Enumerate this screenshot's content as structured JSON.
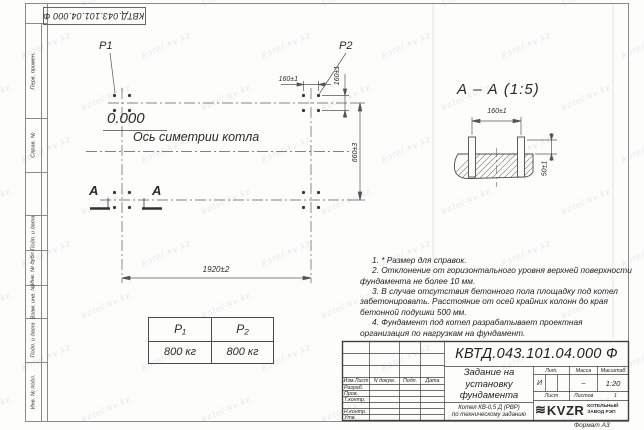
{
  "page": {
    "stamp_top": "КВТД.043.101.04.000 Ф",
    "format_label": "Формат А3",
    "watermark": "kotel-kv.kz"
  },
  "side_strips": [
    "Перв. примен.",
    "Справ. №",
    "",
    "Подп. и дата",
    "Инв. № дубл.",
    "Взам. инв. №",
    "Подп. и дата",
    "Инв. № подл."
  ],
  "plan": {
    "p1_label": "P1",
    "p2_label": "P2",
    "elevation": "0.000",
    "axis_label": "Ось симетрии котла",
    "dim_160_top": "160±1",
    "dim_160_right": "160±1",
    "dim_660": "660±3",
    "dim_1920": "1920±2",
    "section_letter": "А"
  },
  "section": {
    "title": "А – А (1:5)",
    "dim_160": "160±1",
    "dim_50": "50±1"
  },
  "load_table": {
    "headers": [
      "P₁",
      "P₂"
    ],
    "values": [
      "800 кг",
      "800 кг"
    ]
  },
  "notes": [
    "1. * Размер для справок.",
    "2. Отклонение от горизонтального уровня верхней поверхности фундамента не более 10 мм.",
    "3. В случае отсутствия бетонного пола площадку под котел забетонировать. Расстояние от осей крайних колонн до края бетонной подушки 500 мм.",
    "4. Фундамент под котел разрабатывает проектная организация по нагрузкам на фундамент."
  ],
  "title_block": {
    "designation": "КВТД.043.101.04.000  Ф",
    "header_cols": [
      "Изм.Лист",
      "N докум.",
      "Подп.",
      "Дата"
    ],
    "rows": [
      "Разраб.",
      "Пров.",
      "Т.контр.",
      "",
      "Н.контр.",
      "Утв."
    ],
    "title": "Задание на установку фундамента",
    "subtitle_line1": "Котел КВ-0,5 Д (РВР)",
    "subtitle_line2": "по техническому заданию",
    "lit_header": "Лит.",
    "mass_header": "Масса",
    "scale_header": "Масштаб",
    "lit_value": "И",
    "mass_value": "–",
    "scale_value": "1:20",
    "sheet_label": "Лист",
    "sheets_label": "Листов",
    "sheets_value": "1",
    "logo_glyph": "≋",
    "logo_text": "KVZR",
    "logo_sub": "КОТЕЛЬНЫЙ ЗАВОД РЭП"
  }
}
